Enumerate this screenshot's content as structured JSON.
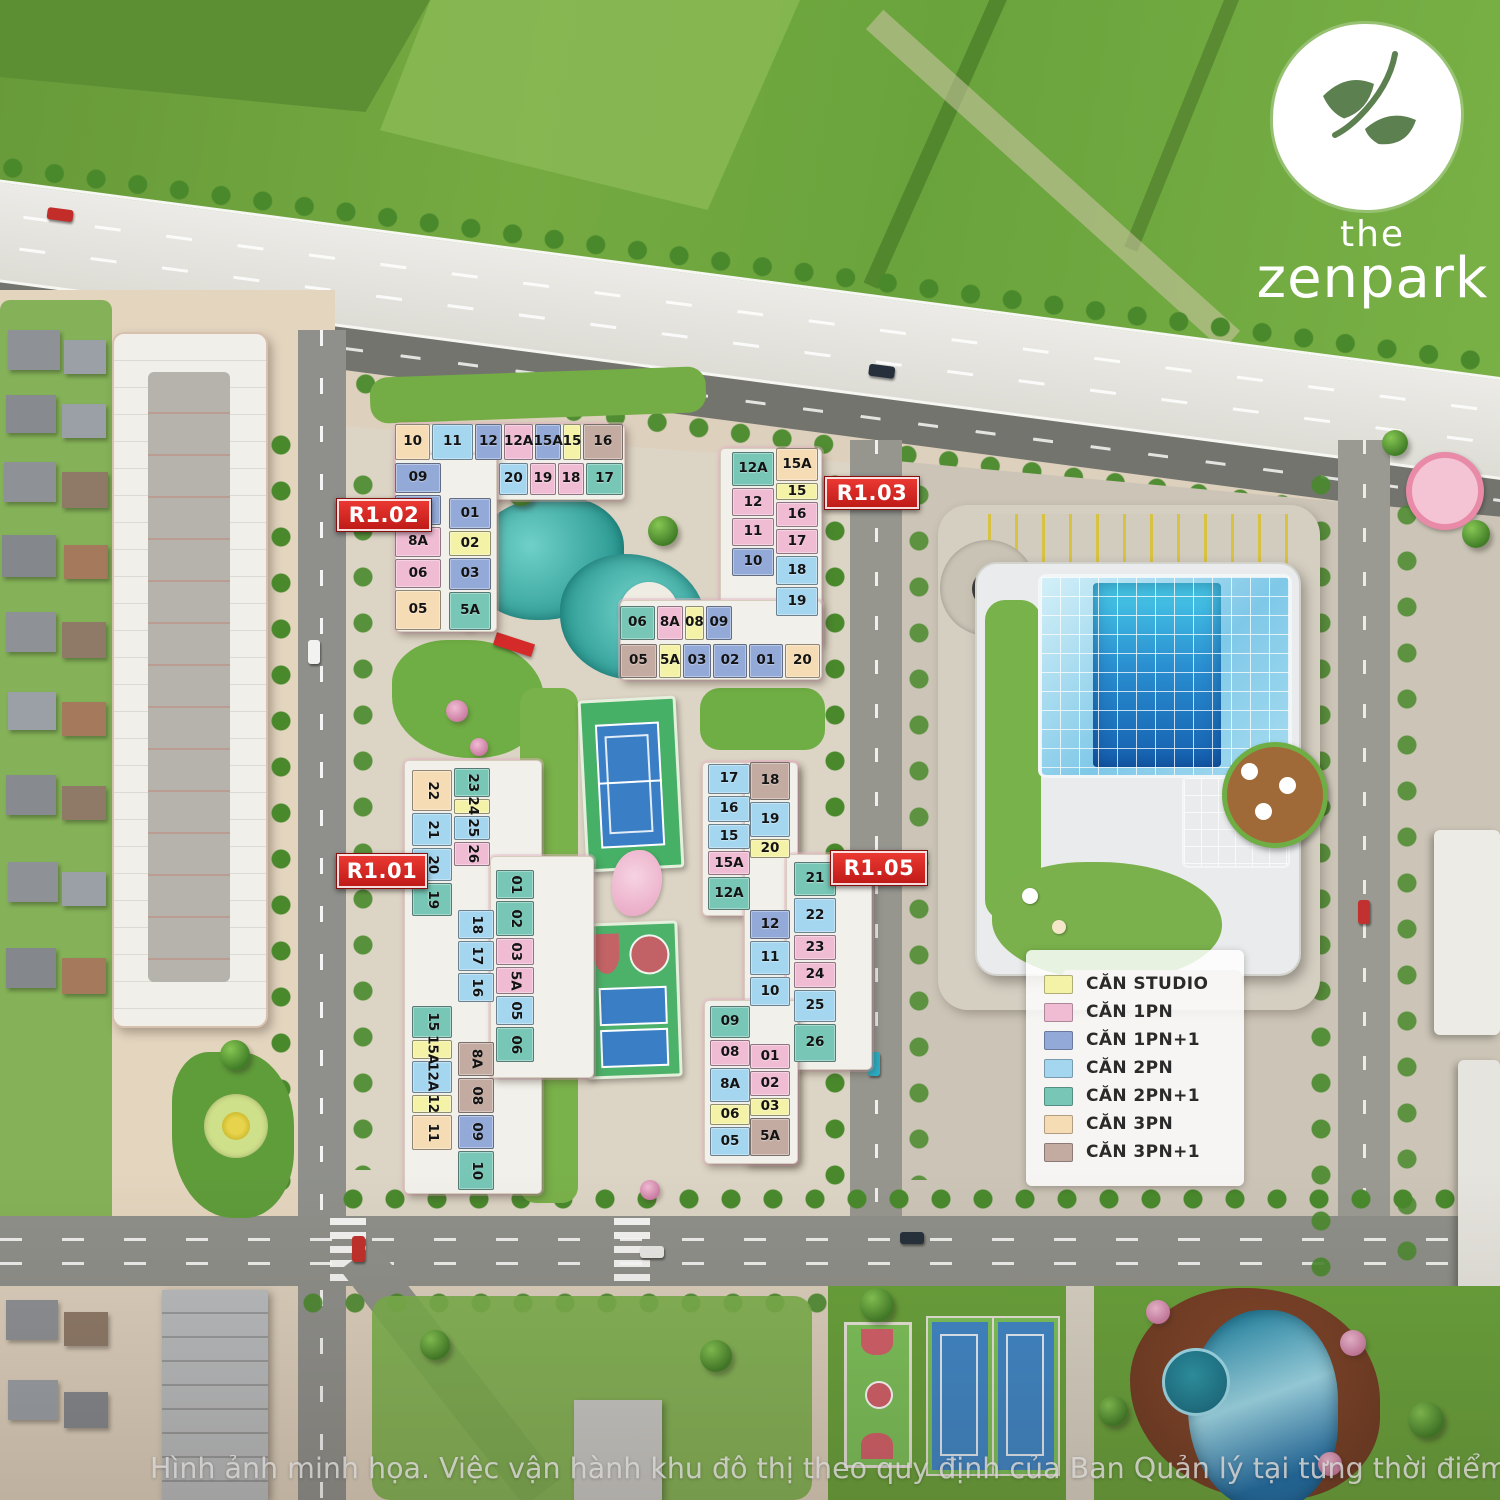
{
  "brand": {
    "the": "the",
    "name": "zenpark"
  },
  "watermark": "Hình ảnh minh họa. Việc vận hành khu đô thị theo quy định của Ban Quản lý tại từng thời điểm.",
  "unit_types": {
    "studio": {
      "label": "CĂN STUDIO",
      "color": "#f4f2a6"
    },
    "1pn": {
      "label": "CĂN 1PN",
      "color": "#f0bcd4"
    },
    "1pn1": {
      "label": "CĂN 1PN+1",
      "color": "#93a9d8"
    },
    "2pn": {
      "label": "CĂN 2PN",
      "color": "#a5d6f0"
    },
    "2pn1": {
      "label": "CĂN 2PN+1",
      "color": "#77c6b6"
    },
    "3pn": {
      "label": "CĂN 3PN",
      "color": "#f6dcb4"
    },
    "3pn1": {
      "label": "CĂN 3PN+1",
      "color": "#c3aba1"
    }
  },
  "legend": {
    "order": [
      "studio",
      "1pn",
      "1pn1",
      "2pn",
      "2pn1",
      "3pn",
      "3pn1"
    ]
  },
  "buildings": {
    "r102": {
      "label": "R1.02",
      "stacks": {
        "top": [
          {
            "n": "10",
            "t": "3pn",
            "s": 1.3
          },
          {
            "n": "11",
            "t": "2pn",
            "s": 1.5
          },
          {
            "n": "12",
            "t": "1pn1",
            "s": 1
          },
          {
            "n": "12A",
            "t": "1pn",
            "s": 1.05
          },
          {
            "n": "15A",
            "t": "1pn1",
            "s": 0.95
          },
          {
            "n": "15",
            "t": "studio",
            "s": 0.6
          },
          {
            "n": "16",
            "t": "3pn1",
            "s": 1.5
          }
        ],
        "row2": [
          {
            "n": "20",
            "t": "2pn",
            "s": 1
          },
          {
            "n": "19",
            "t": "1pn",
            "s": 0.9
          },
          {
            "n": "18",
            "t": "1pn",
            "s": 0.9
          },
          {
            "n": "17",
            "t": "2pn1",
            "s": 1.3
          }
        ],
        "left": [
          {
            "n": "09",
            "t": "1pn1",
            "s": 1
          },
          {
            "n": "08",
            "t": "1pn1",
            "s": 1
          },
          {
            "n": "8A",
            "t": "1pn",
            "s": 1
          },
          {
            "n": "06",
            "t": "1pn",
            "s": 1
          },
          {
            "n": "05",
            "t": "3pn",
            "s": 1.35
          }
        ],
        "inner": [
          {
            "n": "01",
            "t": "1pn1",
            "s": 1
          },
          {
            "n": "02",
            "t": "studio",
            "s": 0.8
          },
          {
            "n": "03",
            "t": "1pn1",
            "s": 1
          },
          {
            "n": "5A",
            "t": "2pn1",
            "s": 1.25
          }
        ]
      }
    },
    "r103": {
      "label": "R1.03",
      "stacks": {
        "innerCol": [
          {
            "n": "12A",
            "t": "2pn1",
            "s": 1.25
          },
          {
            "n": "12",
            "t": "1pn",
            "s": 1
          },
          {
            "n": "11",
            "t": "1pn",
            "s": 1
          },
          {
            "n": "10",
            "t": "1pn1",
            "s": 1
          }
        ],
        "outerCol": [
          {
            "n": "15A",
            "t": "3pn",
            "s": 1.35
          },
          {
            "n": "15",
            "t": "studio",
            "s": 0.7
          },
          {
            "n": "16",
            "t": "1pn",
            "s": 1
          },
          {
            "n": "17",
            "t": "1pn",
            "s": 1
          },
          {
            "n": "18",
            "t": "2pn",
            "s": 1.2
          },
          {
            "n": "19",
            "t": "2pn",
            "s": 1.2
          }
        ],
        "rowTop": [
          {
            "n": "06",
            "t": "2pn1",
            "s": 1.35
          },
          {
            "n": "8A",
            "t": "1pn",
            "s": 1
          },
          {
            "n": "08",
            "t": "studio",
            "s": 0.7
          },
          {
            "n": "09",
            "t": "1pn1",
            "s": 1
          }
        ],
        "rowBottom": [
          {
            "n": "05",
            "t": "3pn1",
            "s": 1.2
          },
          {
            "n": "5A",
            "t": "studio",
            "s": 0.7
          },
          {
            "n": "03",
            "t": "1pn1",
            "s": 0.9
          },
          {
            "n": "02",
            "t": "1pn1",
            "s": 1.1
          },
          {
            "n": "01",
            "t": "1pn1",
            "s": 1.1
          },
          {
            "n": "20",
            "t": "3pn",
            "s": 1.15
          }
        ]
      }
    },
    "r101": {
      "label": "R1.01",
      "stacks": {
        "colA": [
          {
            "n": "22",
            "t": "3pn",
            "s": 1.25
          },
          {
            "n": "21",
            "t": "2pn",
            "s": 1
          },
          {
            "n": "20",
            "t": "2pn",
            "s": 1
          },
          {
            "n": "19",
            "t": "2pn1",
            "s": 1
          }
        ],
        "col2": [
          {
            "n": "23",
            "t": "2pn1",
            "s": 1.2
          },
          {
            "n": "24",
            "t": "studio",
            "s": 0.6
          },
          {
            "n": "25",
            "t": "2pn",
            "s": 1
          },
          {
            "n": "26",
            "t": "1pn",
            "s": 1
          }
        ],
        "midA": [
          {
            "n": "18",
            "t": "2pn",
            "s": 1
          },
          {
            "n": "17",
            "t": "2pn",
            "s": 1
          },
          {
            "n": "16",
            "t": "2pn",
            "s": 1
          }
        ],
        "rightCol": [
          {
            "n": "01",
            "t": "2pn1",
            "s": 1
          },
          {
            "n": "02",
            "t": "2pn1",
            "s": 1.2
          },
          {
            "n": "03",
            "t": "1pn",
            "s": 0.9
          },
          {
            "n": "5A",
            "t": "1pn",
            "s": 0.9
          },
          {
            "n": "05",
            "t": "2pn",
            "s": 1
          },
          {
            "n": "06",
            "t": "2pn1",
            "s": 1.2
          }
        ],
        "colB": [
          {
            "n": "15",
            "t": "2pn1",
            "s": 1
          },
          {
            "n": "15A",
            "t": "studio",
            "s": 0.55
          },
          {
            "n": "12A",
            "t": "2pn",
            "s": 1
          },
          {
            "n": "12",
            "t": "studio",
            "s": 0.55
          },
          {
            "n": "11",
            "t": "3pn",
            "s": 1.1
          }
        ],
        "midB": [
          {
            "n": "8A",
            "t": "3pn1",
            "s": 1
          },
          {
            "n": "08",
            "t": "3pn1",
            "s": 1
          },
          {
            "n": "09",
            "t": "1pn1",
            "s": 1
          },
          {
            "n": "10",
            "t": "2pn1",
            "s": 1.15
          }
        ]
      }
    },
    "r105": {
      "label": "R1.05",
      "stacks": {
        "leftUp": [
          {
            "n": "17",
            "t": "2pn",
            "s": 1.2
          },
          {
            "n": "16",
            "t": "2pn",
            "s": 1
          },
          {
            "n": "15",
            "t": "2pn",
            "s": 1
          },
          {
            "n": "15A",
            "t": "1pn",
            "s": 0.95
          },
          {
            "n": "12A",
            "t": "2pn1",
            "s": 1.3
          }
        ],
        "midTop": [
          {
            "n": "18",
            "t": "3pn1",
            "s": 1.3
          },
          {
            "n": "19",
            "t": "2pn",
            "s": 1.2
          },
          {
            "n": "20",
            "t": "studio",
            "s": 0.6
          }
        ],
        "midMid": [
          {
            "n": "12",
            "t": "1pn1",
            "s": 1
          },
          {
            "n": "11",
            "t": "2pn",
            "s": 1.2
          },
          {
            "n": "10",
            "t": "2pn",
            "s": 1
          }
        ],
        "midBot": [
          {
            "n": "01",
            "t": "1pn",
            "s": 0.9
          },
          {
            "n": "02",
            "t": "1pn",
            "s": 0.9
          },
          {
            "n": "03",
            "t": "studio",
            "s": 0.6
          },
          {
            "n": "5A",
            "t": "3pn1",
            "s": 1.4
          }
        ],
        "rightCol": [
          {
            "n": "21",
            "t": "2pn1",
            "s": 1.15
          },
          {
            "n": "22",
            "t": "2pn",
            "s": 1.2
          },
          {
            "n": "23",
            "t": "1pn",
            "s": 0.85
          },
          {
            "n": "24",
            "t": "1pn",
            "s": 0.85
          },
          {
            "n": "25",
            "t": "2pn",
            "s": 1.1
          },
          {
            "n": "26",
            "t": "2pn1",
            "s": 1.3
          }
        ],
        "leftLow": [
          {
            "n": "09",
            "t": "2pn1",
            "s": 1.1
          },
          {
            "n": "08",
            "t": "1pn",
            "s": 0.9
          },
          {
            "n": "8A",
            "t": "2pn",
            "s": 1.2
          },
          {
            "n": "06",
            "t": "studio",
            "s": 0.7
          },
          {
            "n": "05",
            "t": "2pn",
            "s": 1
          }
        ]
      }
    }
  }
}
